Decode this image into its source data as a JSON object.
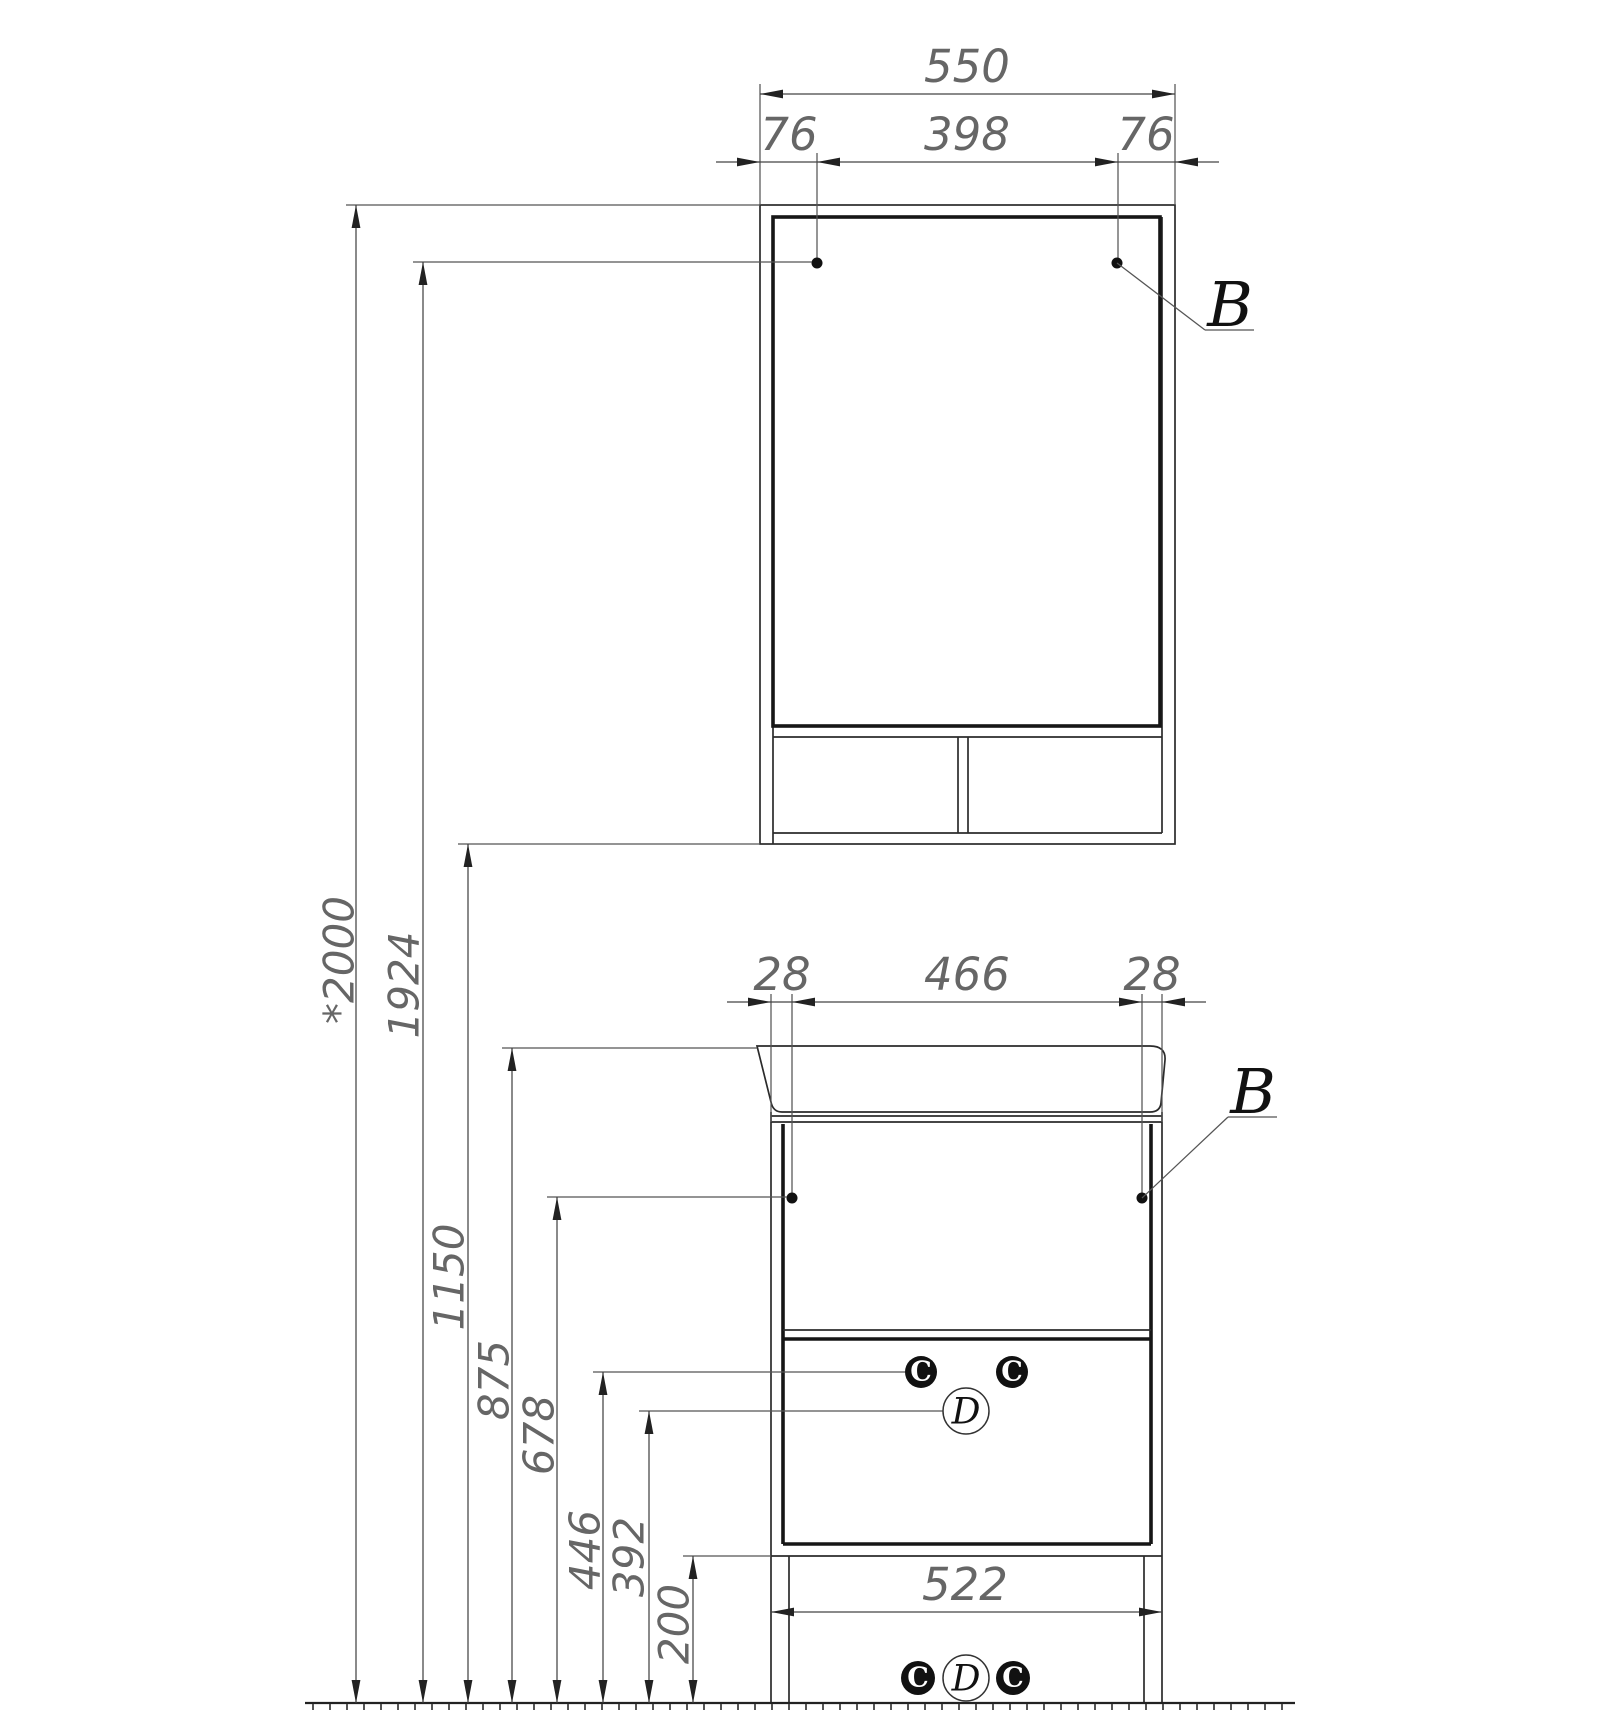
{
  "dims": {
    "d550": "550",
    "d76l": "76",
    "d398": "398",
    "d76r": "76",
    "d28l": "28",
    "d466": "466",
    "d28r": "28",
    "d522": "522",
    "h2000": "*2000",
    "h1924": "1924",
    "h1150": "1150",
    "h875": "875",
    "h678": "678",
    "h446": "446",
    "h392": "392",
    "h200": "200"
  },
  "callouts": {
    "b": "B",
    "c": "C",
    "d": "D"
  },
  "colors": {
    "line": "#2b2b2b",
    "dim_line": "#555",
    "dim_text": "#666",
    "callout_fill": "#111",
    "background": "#ffffff"
  }
}
